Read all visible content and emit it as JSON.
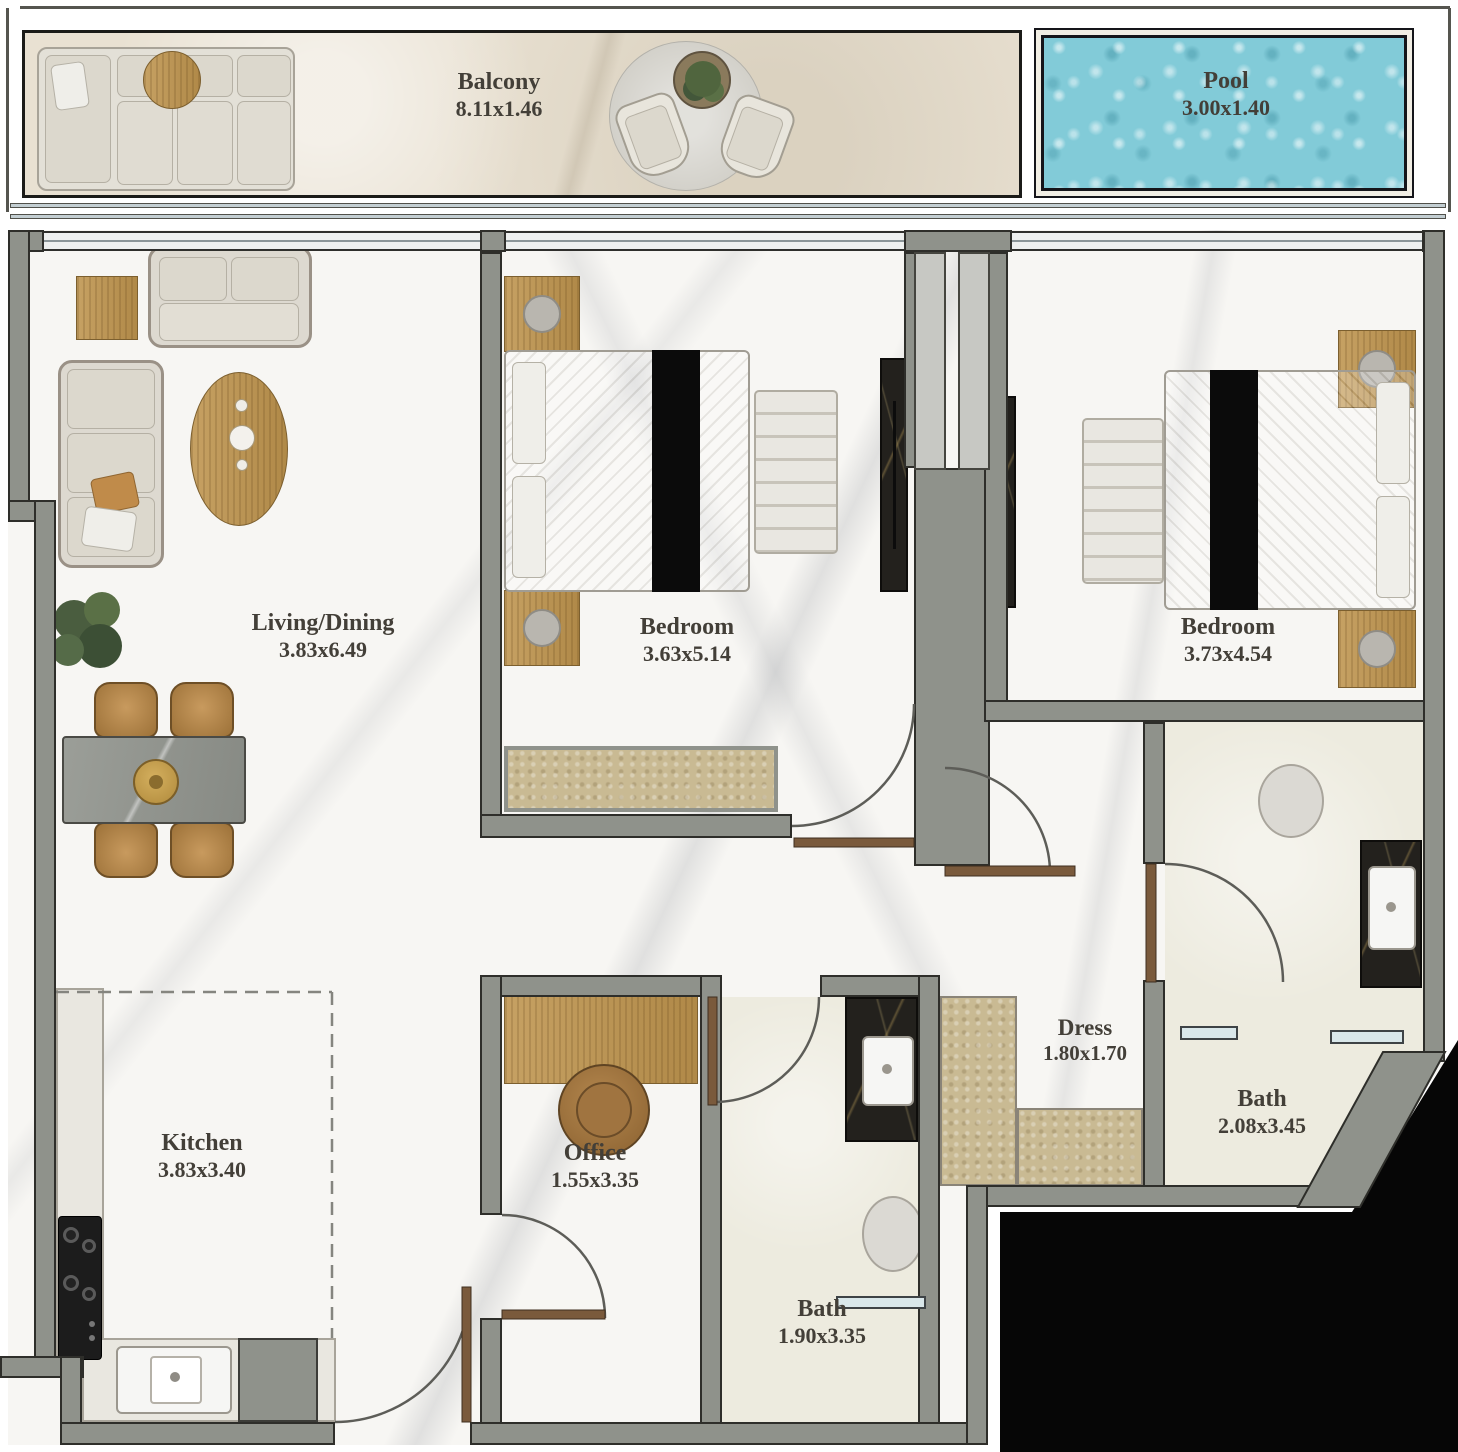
{
  "rooms": {
    "balcony": {
      "name": "Balcony",
      "dims": "8.11x1.46"
    },
    "pool": {
      "name": "Pool",
      "dims": "3.00x1.40"
    },
    "living": {
      "name": "Living/Dining",
      "dims": "3.83x6.49"
    },
    "bedroom1": {
      "name": "Bedroom",
      "dims": "3.63x5.14"
    },
    "bedroom2": {
      "name": "Bedroom",
      "dims": "3.73x4.54"
    },
    "kitchen": {
      "name": "Kitchen",
      "dims": "3.83x3.40"
    },
    "office": {
      "name": "Office",
      "dims": "1.55x3.35"
    },
    "bath1": {
      "name": "Bath",
      "dims": "1.90x3.35"
    },
    "dress": {
      "name": "Dress",
      "dims": "1.80x1.70"
    },
    "bath2": {
      "name": "Bath",
      "dims": "2.08x3.45"
    }
  },
  "palette": {
    "wall": "#8f928b",
    "wall_outline": "#2e2e2a",
    "floor_marble": "#f7f6f3",
    "bath_floor": "#edebdf",
    "balcony_floor": "#e9e1d2",
    "pool_water": "#82cbd8",
    "wood_gold": "#c19a5d",
    "dark_marble": "#23211d",
    "tan_wardrobe": "#c9ba93",
    "label_text": "#433f38",
    "outside_cut": "#060606"
  },
  "furniture": [
    "outdoor-sofa",
    "outdoor-side-table",
    "outdoor-rug",
    "outdoor-chairs",
    "outdoor-table-plant",
    "loveseat",
    "sofa",
    "coffee-table",
    "side-table",
    "plant",
    "dining-table",
    "dining-chairs",
    "bed",
    "pillows",
    "bed-runner",
    "nightstand",
    "bedside-lamp",
    "bench",
    "dresser",
    "wardrobe",
    "desk",
    "desk-chair",
    "kitchen-counter",
    "stove",
    "kitchen-sink",
    "cabinet",
    "toilet",
    "washbasin",
    "vanity-counter"
  ]
}
